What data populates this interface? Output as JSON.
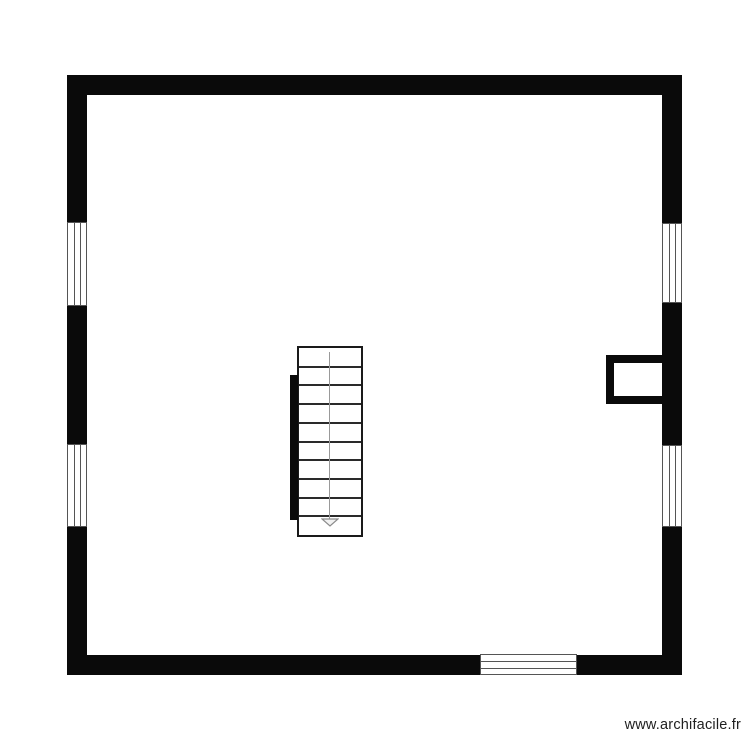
{
  "watermark": {
    "text": "www.archifacile.fr",
    "color": "#1f1f1f"
  },
  "plan": {
    "background": "#ffffff",
    "wall_color": "#0a0a0a",
    "window_line_color": "#555555",
    "walls": [
      "top",
      "right",
      "bottom",
      "left"
    ],
    "windows": [
      {
        "name": "left-window-1",
        "wall": "left"
      },
      {
        "name": "left-window-2",
        "wall": "left"
      },
      {
        "name": "right-window-1",
        "wall": "right"
      },
      {
        "name": "right-window-2",
        "wall": "right"
      },
      {
        "name": "bottom-window",
        "wall": "bottom"
      }
    ],
    "chimney": {
      "wall": "right"
    },
    "stairs": {
      "steps": 10,
      "direction": "down",
      "tread_color": "#2a2a2a",
      "guide_color": "#999999"
    }
  }
}
